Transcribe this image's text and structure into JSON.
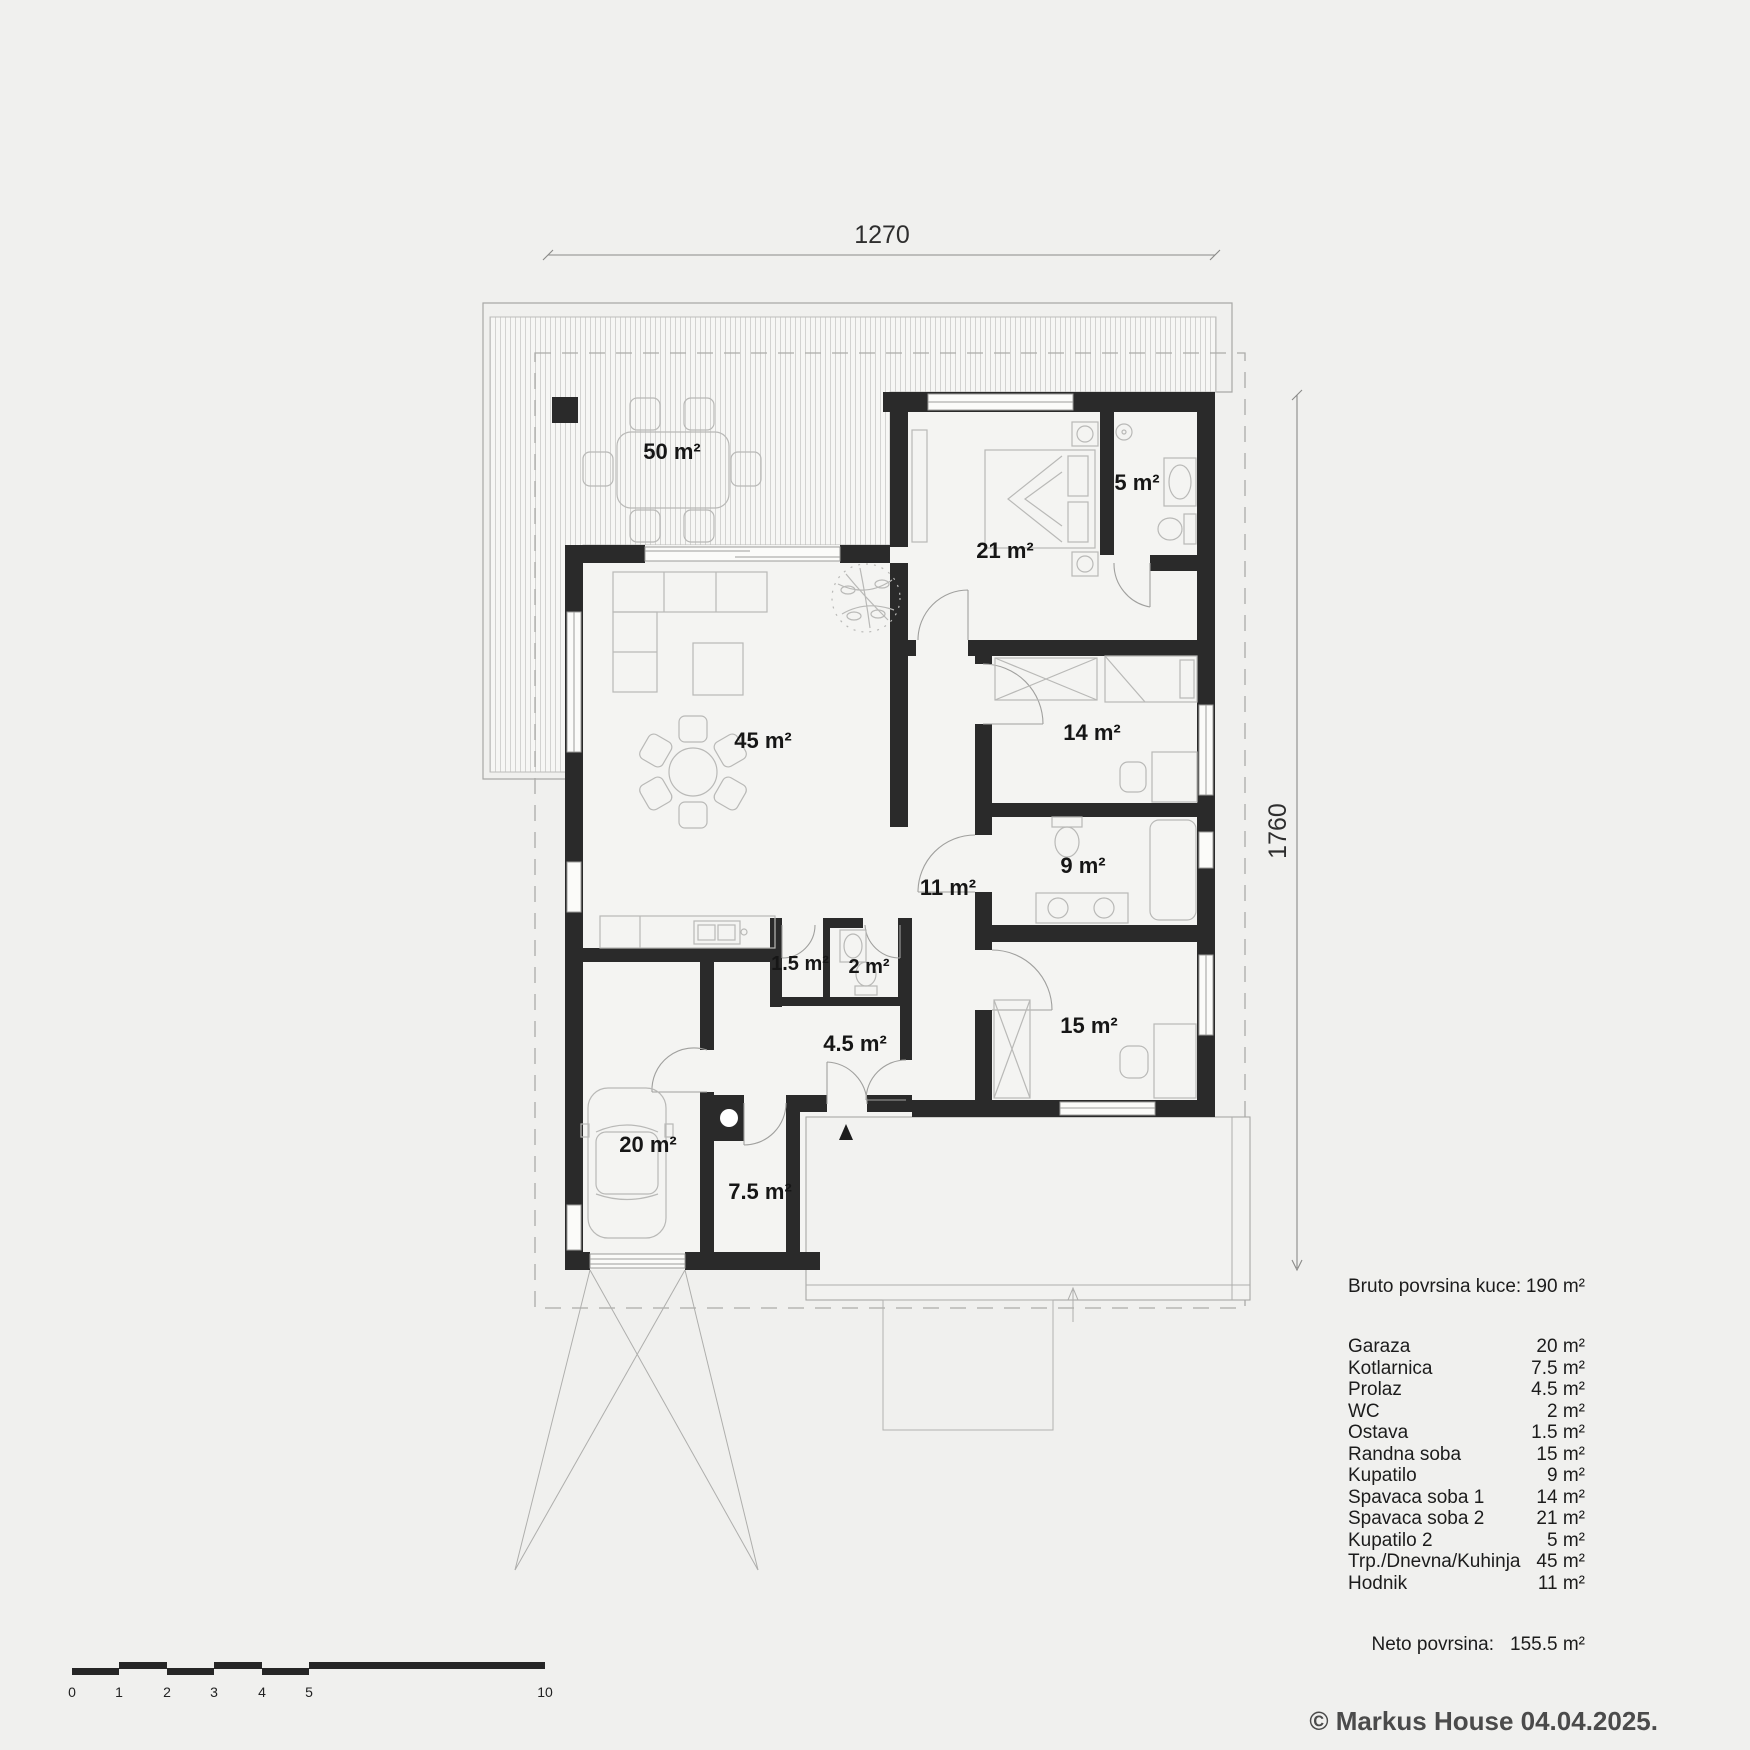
{
  "plan": {
    "labels": [
      {
        "id": "terrace",
        "text": "50 m²"
      },
      {
        "id": "living",
        "text": "45 m²"
      },
      {
        "id": "bedroom-2",
        "text": "21 m²"
      },
      {
        "id": "bathroom-2",
        "text": "5 m²"
      },
      {
        "id": "bedroom-1",
        "text": "14 m²"
      },
      {
        "id": "bathroom",
        "text": "9 m²"
      },
      {
        "id": "hallway",
        "text": "11 m²"
      },
      {
        "id": "workroom",
        "text": "15 m²"
      },
      {
        "id": "storage",
        "text": "1.5 m²"
      },
      {
        "id": "wc",
        "text": "2 m²"
      },
      {
        "id": "passage",
        "text": "4.5 m²"
      },
      {
        "id": "garage",
        "text": "20 m²"
      },
      {
        "id": "boiler-room",
        "text": "7.5 m²"
      }
    ]
  },
  "dimensions": {
    "top": "1270",
    "right": "1760"
  },
  "scale_bar": {
    "ticks": [
      "0",
      "1",
      "2",
      "3",
      "4",
      "5",
      "10"
    ]
  },
  "legend": {
    "gross_label": "Bruto povrsina kuce:",
    "gross_value": "190 m²",
    "rooms": [
      {
        "name": "Garaza",
        "area": "20 m²"
      },
      {
        "name": "Kotlarnica",
        "area": "7.5 m²"
      },
      {
        "name": "Prolaz",
        "area": "4.5 m²"
      },
      {
        "name": "WC",
        "area": "2 m²"
      },
      {
        "name": "Ostava",
        "area": "1.5 m²"
      },
      {
        "name": "Randna soba",
        "area": "15 m²"
      },
      {
        "name": "Kupatilo",
        "area": "9 m²"
      },
      {
        "name": "Spavaca soba 1",
        "area": "14 m²"
      },
      {
        "name": "Spavaca soba 2",
        "area": "21 m²"
      },
      {
        "name": "Kupatilo 2",
        "area": "5 m²"
      },
      {
        "name": "Trp./Dnevna/Kuhinja",
        "area": "45 m²"
      },
      {
        "name": "Hodnik",
        "area": "11 m²"
      }
    ],
    "net_label": "Neto povrsina:",
    "net_value": "155.5 m²"
  },
  "footer": {
    "copyright": "© Markus House 04.04.2025."
  },
  "colors": {
    "wall": "#2a2a2a",
    "background": "#f0f0ee",
    "copyright": "#4b4b4b"
  }
}
